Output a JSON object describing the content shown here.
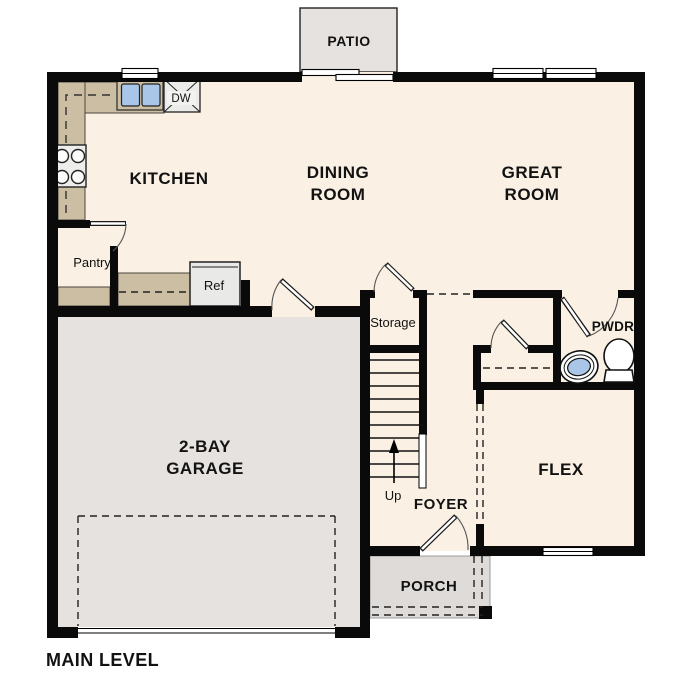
{
  "plan": {
    "title": "MAIN LEVEL",
    "rooms": {
      "patio": "PATIO",
      "kitchen": "KITCHEN",
      "dining_line1": "DINING",
      "dining_line2": "ROOM",
      "great_line1": "GREAT",
      "great_line2": "ROOM",
      "pantry": "Pantry",
      "storage": "Storage",
      "pwdr": "PWDR",
      "garage_line1": "2-BAY",
      "garage_line2": "GARAGE",
      "flex": "FLEX",
      "foyer": "FOYER",
      "porch": "PORCH"
    },
    "fixtures": {
      "refrigerator": "Ref",
      "dishwasher": "DW",
      "stairs_direction": "Up"
    },
    "colors": {
      "floor_cream": "#faf0e3",
      "floor_gray": "#e5e2df",
      "porch_gray": "#dedbd8",
      "counter_tan": "#cbbea3",
      "fixture_blue": "#a9c6e8",
      "appliance_gray": "#ebebe9",
      "wall_black": "#0a0a0a"
    }
  }
}
